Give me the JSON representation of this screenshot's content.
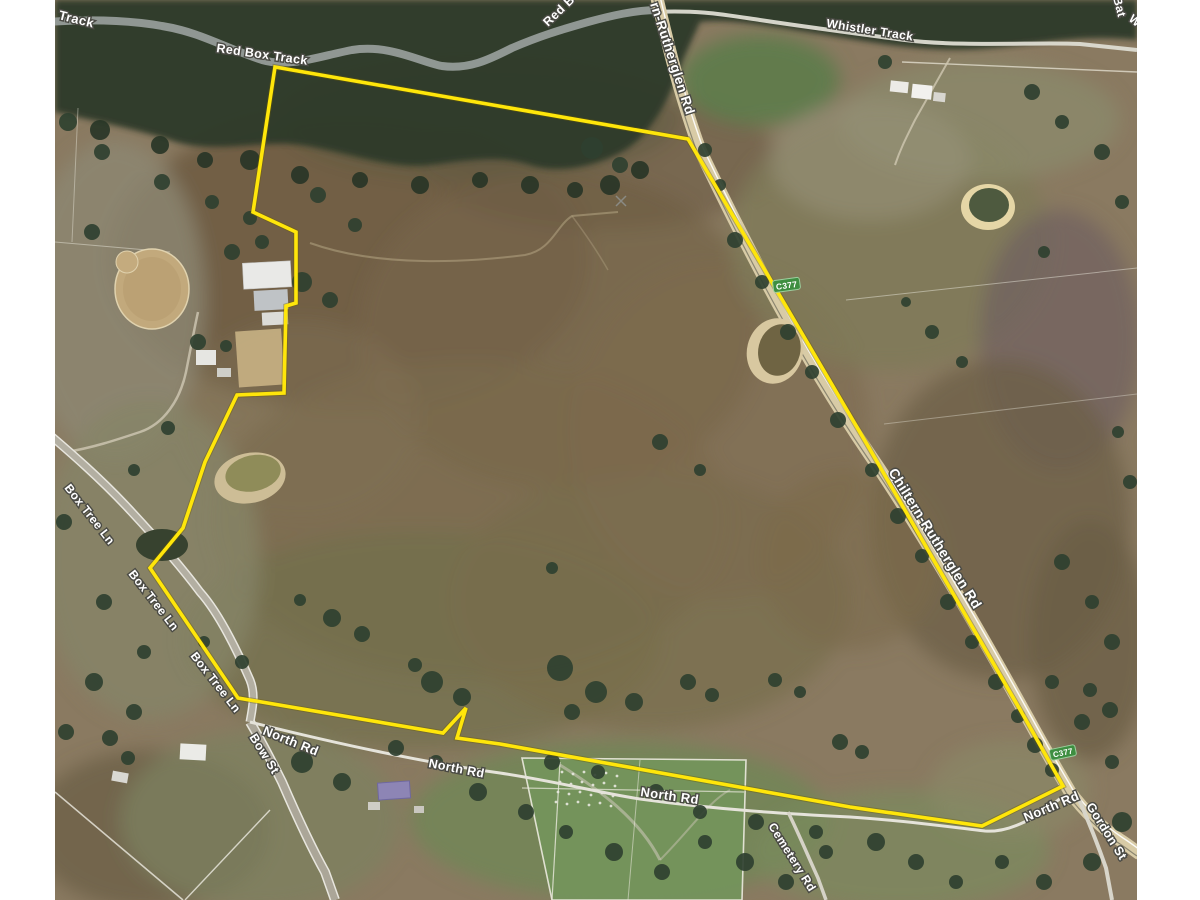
{
  "map": {
    "boundary_color": "#ffe60a",
    "route_shield_color": "#3e8e41",
    "road_labels": {
      "corner_track_partial": "n Track",
      "red_box_track": "Red Box Track",
      "red_box_partial": "Red B",
      "rutherglen_rd_top": "rn-Rutherglen Rd",
      "whistler_track": "Whistler Track",
      "top_right_partial": "Bat",
      "right_edge_partial": "W",
      "chiltern_rutherglen_rd": "Chiltern-Rutherglen Rd",
      "box_tree_ln_1": "Box Tree Ln",
      "box_tree_ln_2": "Box Tree Ln",
      "box_tree_ln_3": "Box Tree Ln",
      "bow_st": "Bow St",
      "north_rd_1": "North Rd",
      "north_rd_2": "North Rd",
      "north_rd_3": "North Rd",
      "north_rd_4": "North Rd",
      "cemetery_rd": "Cemetery Rd",
      "gordon_st": "Gordon St",
      "route_c377_north": "C377",
      "route_c377_south": "C377"
    }
  }
}
